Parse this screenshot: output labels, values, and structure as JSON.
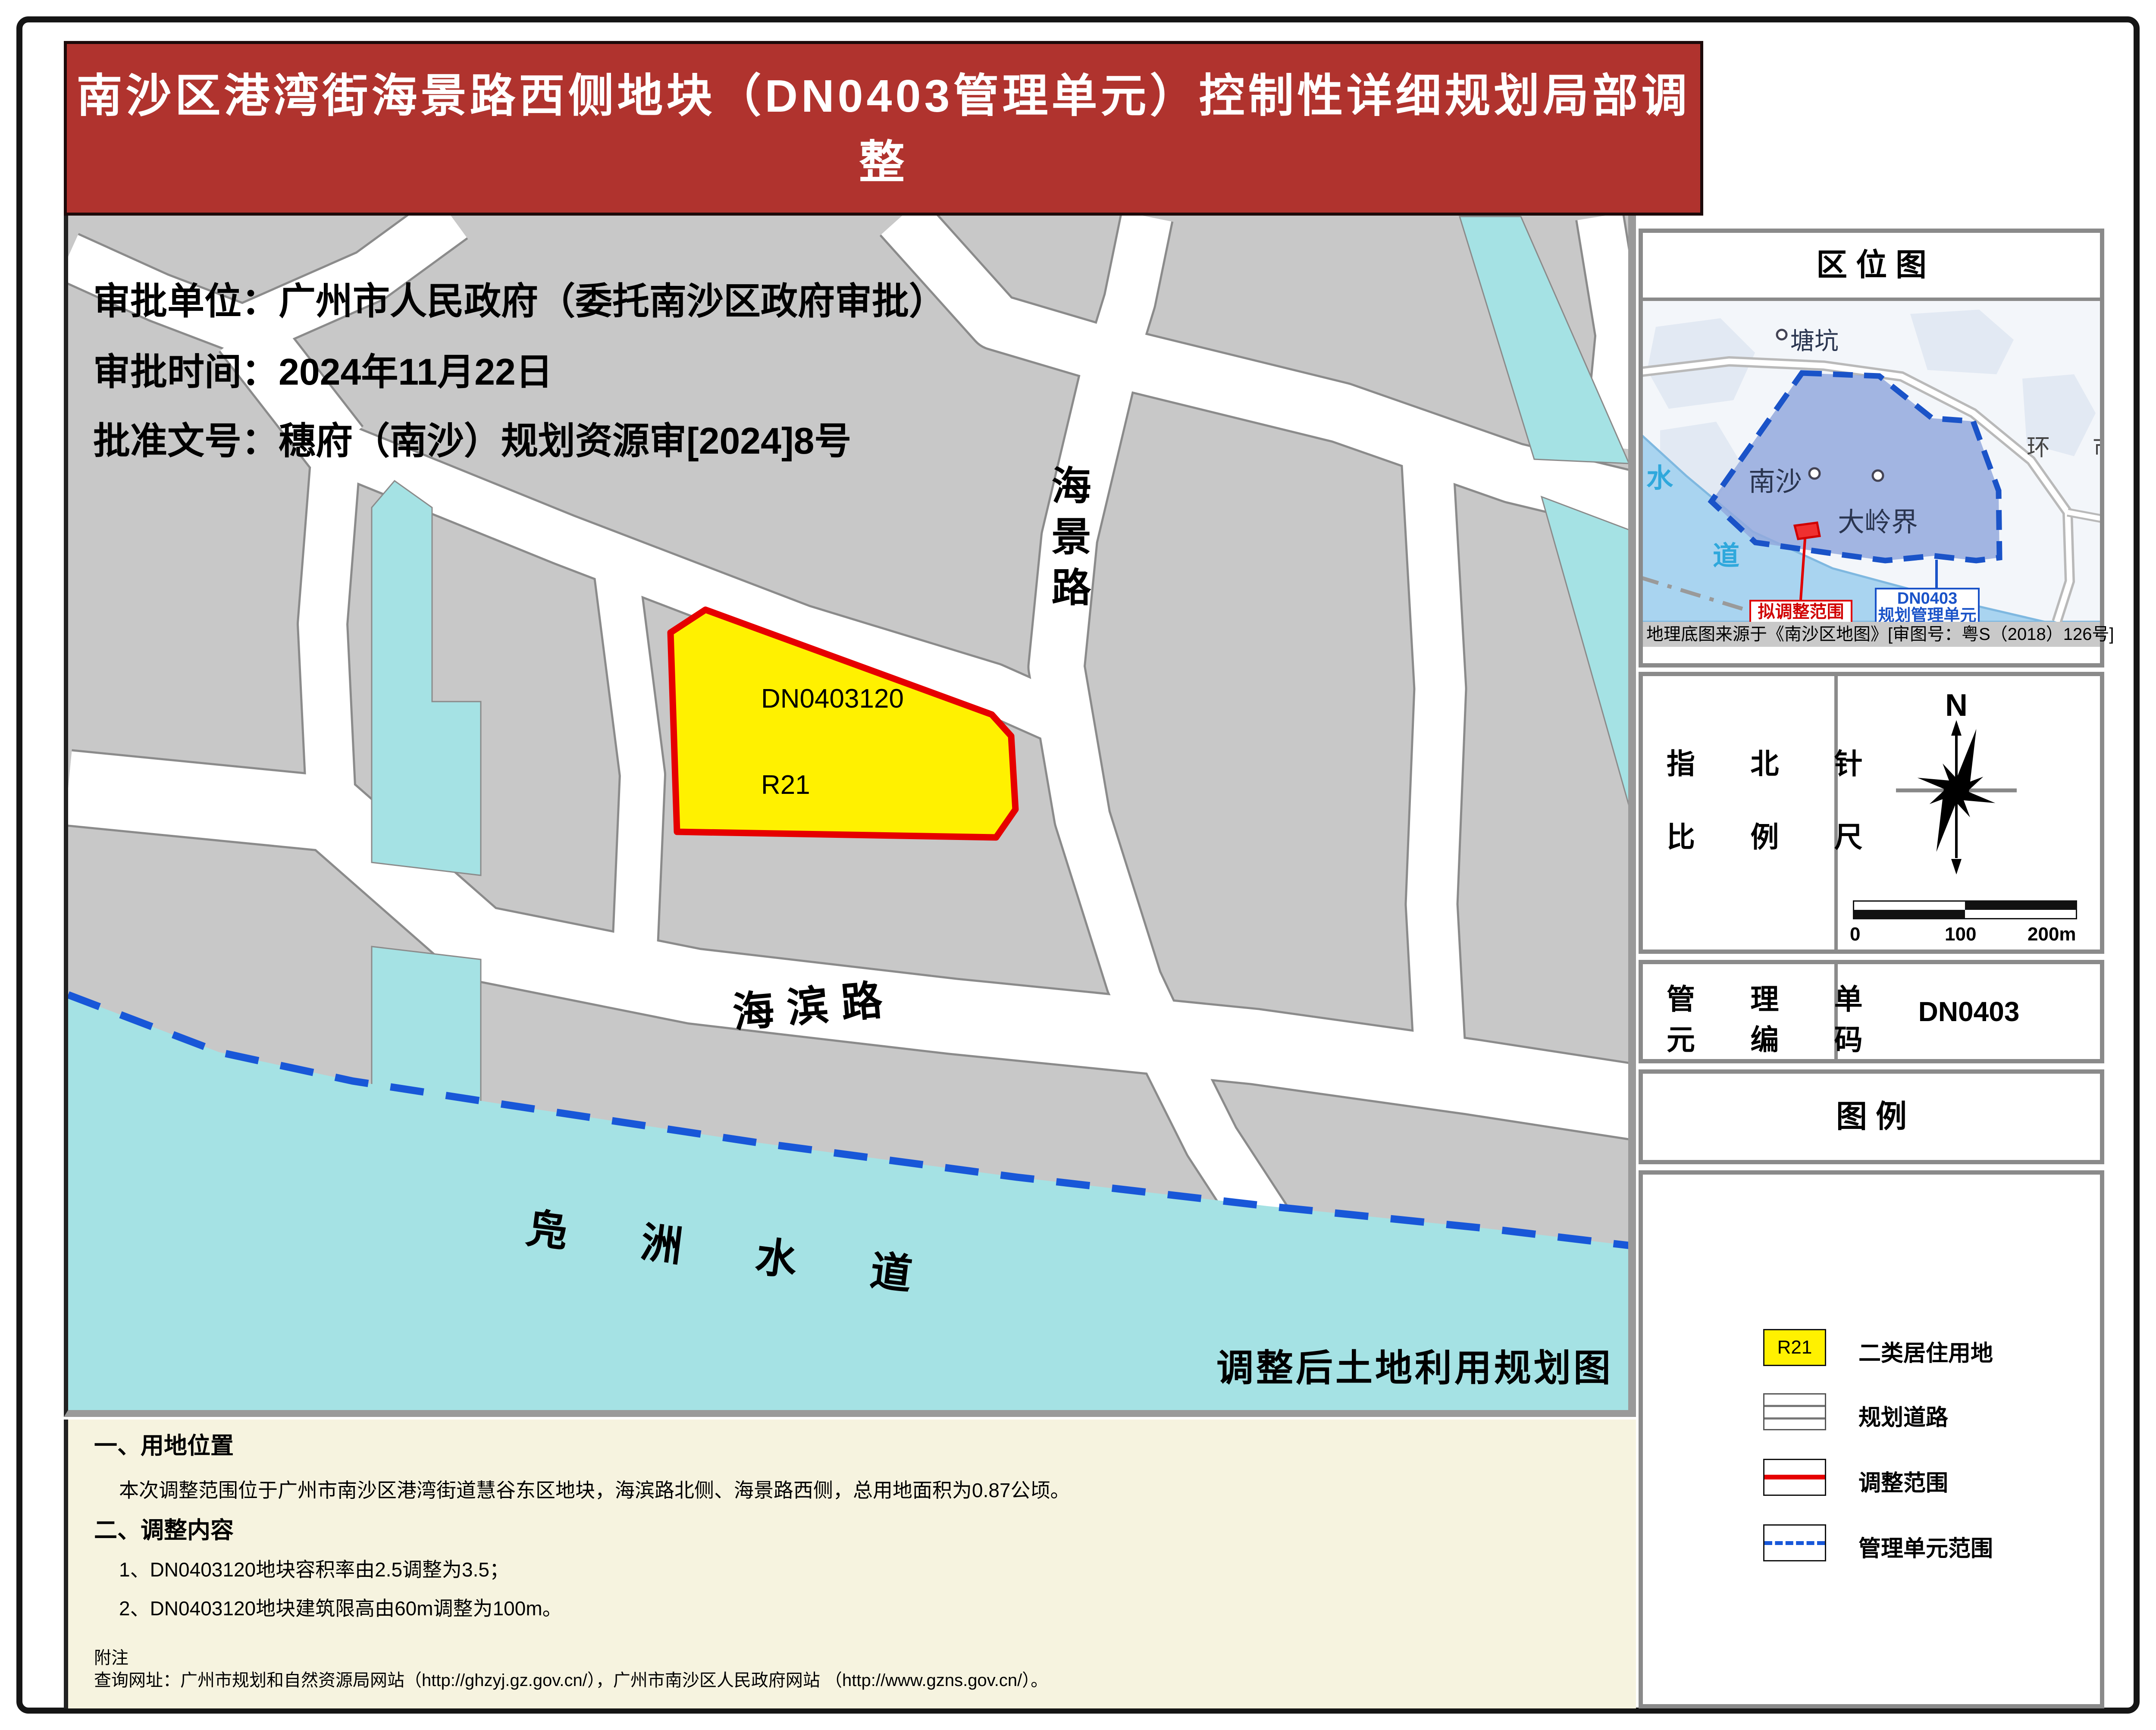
{
  "page": {
    "title_line1": "南沙区港湾街海景路西侧地块（DN0403管理单元）控制性详细规划局部调整",
    "title_line2": "批后通告图"
  },
  "approval": {
    "unit": "审批单位：广州市人民政府（委托南沙区政府审批）",
    "date": "审批时间：2024年11月22日",
    "doc_no": "批准文号：穗府（南沙）规划资源审[2024]8号"
  },
  "map": {
    "parcel_code": "DN0403120",
    "parcel_use": "R21",
    "road_vertical": "海景路",
    "road_horizontal": "海滨路",
    "water_name": "凫洲水道",
    "caption": "调整后土地利用规划图"
  },
  "sidebar": {
    "location": {
      "title": "区  位  图",
      "tangkeng": "塘坑",
      "nansha": "南沙",
      "dalingjie": "大岭界",
      "huanshi": "环 市",
      "water_char1": "水",
      "water_char2": "道",
      "red_label": "拟调整范围",
      "blue_label_line1": "DN0403",
      "blue_label_line2": "规划管理单元",
      "source_note": "地理底图来源于《南沙区地图》[审图号：粤S（2018）126号]"
    },
    "compass": {
      "north": "N",
      "label1": "指 北 针",
      "label2": "比 例 尺",
      "ticks": [
        "0",
        "100",
        "200m"
      ]
    },
    "unit_code": {
      "label1": "管 理 单",
      "label2": "元 编 码",
      "value": "DN0403"
    },
    "legend": {
      "title": "图        例",
      "items": [
        {
          "swatch": "R21",
          "label": "二类居住用地"
        },
        {
          "label": "规划道路"
        },
        {
          "label": "调整范围"
        },
        {
          "label": "管理单元范围"
        }
      ]
    }
  },
  "notes": {
    "h1": "一、用地位置",
    "p1": "本次调整范围位于广州市南沙区港湾街道慧谷东区地块，海滨路北侧、海景路西侧，总用地面积为0.87公顷。",
    "h2": "二、调整内容",
    "i1": "1、DN0403120地块容积率由2.5调整为3.5；",
    "i2": "2、DN0403120地块建筑限高由60m调整为100m。",
    "fu": "附注",
    "url": "查询网址：广州市规划和自然资源局网站（http://ghzyj.gz.gov.cn/），广州市南沙区人民政府网站 （http://www.gzns.gov.cn/）。"
  },
  "colors": {
    "title_red": "#B0332E",
    "block_gray": "#C8C8C8",
    "water_cyan": "#A5E2E4",
    "boundary_blue": "#1857D8",
    "parcel_yellow": "#FFF100",
    "parcel_border_red": "#E60000",
    "unit_fill_blue": "#93A9DD",
    "cream": "#F6F3DF"
  }
}
